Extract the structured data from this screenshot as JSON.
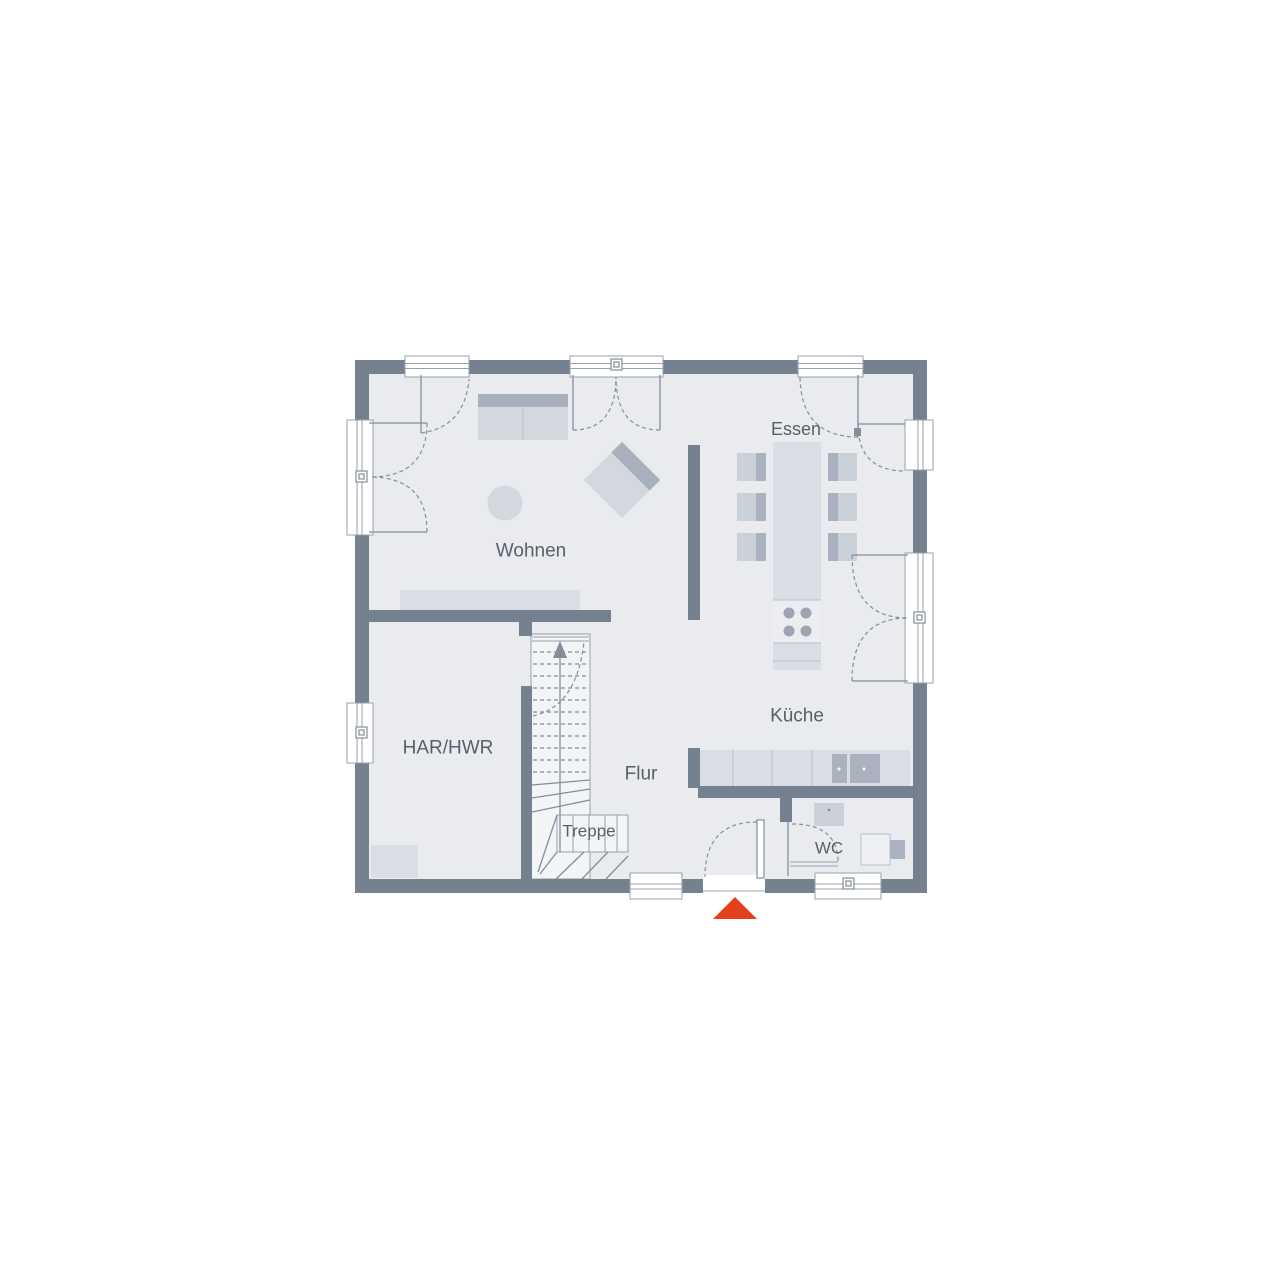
{
  "floor_plan": {
    "rooms": {
      "essen": {
        "label": "Essen"
      },
      "wohnen": {
        "label": "Wohnen"
      },
      "har_hwr": {
        "label": "HAR/HWR"
      },
      "flur": {
        "label": "Flur"
      },
      "treppe": {
        "label": "Treppe"
      },
      "kueche": {
        "label": "Küche"
      },
      "wc": {
        "label": "WC"
      }
    },
    "entrance_marker": {
      "icon": "entrance-triangle-icon"
    },
    "stairs": {
      "direction_arrow": "up"
    }
  },
  "colors": {
    "accent": "#E5401E",
    "wall": "#76818F",
    "floor": "#E9EBEF",
    "stair": "#F2F4F6",
    "furn": "#D3D8DF",
    "furn-dark": "#A9B1BD",
    "furn-light": "#DADEE4",
    "chair": "#CBD1D9",
    "chair-dark": "#A9B2BE",
    "cooktop": "#EBEDF0",
    "burner": "#9CA5B1",
    "line": "#98A0AC",
    "line2": "#848E9B",
    "seam": "#B9C0CA",
    "text": "#585F6A"
  }
}
